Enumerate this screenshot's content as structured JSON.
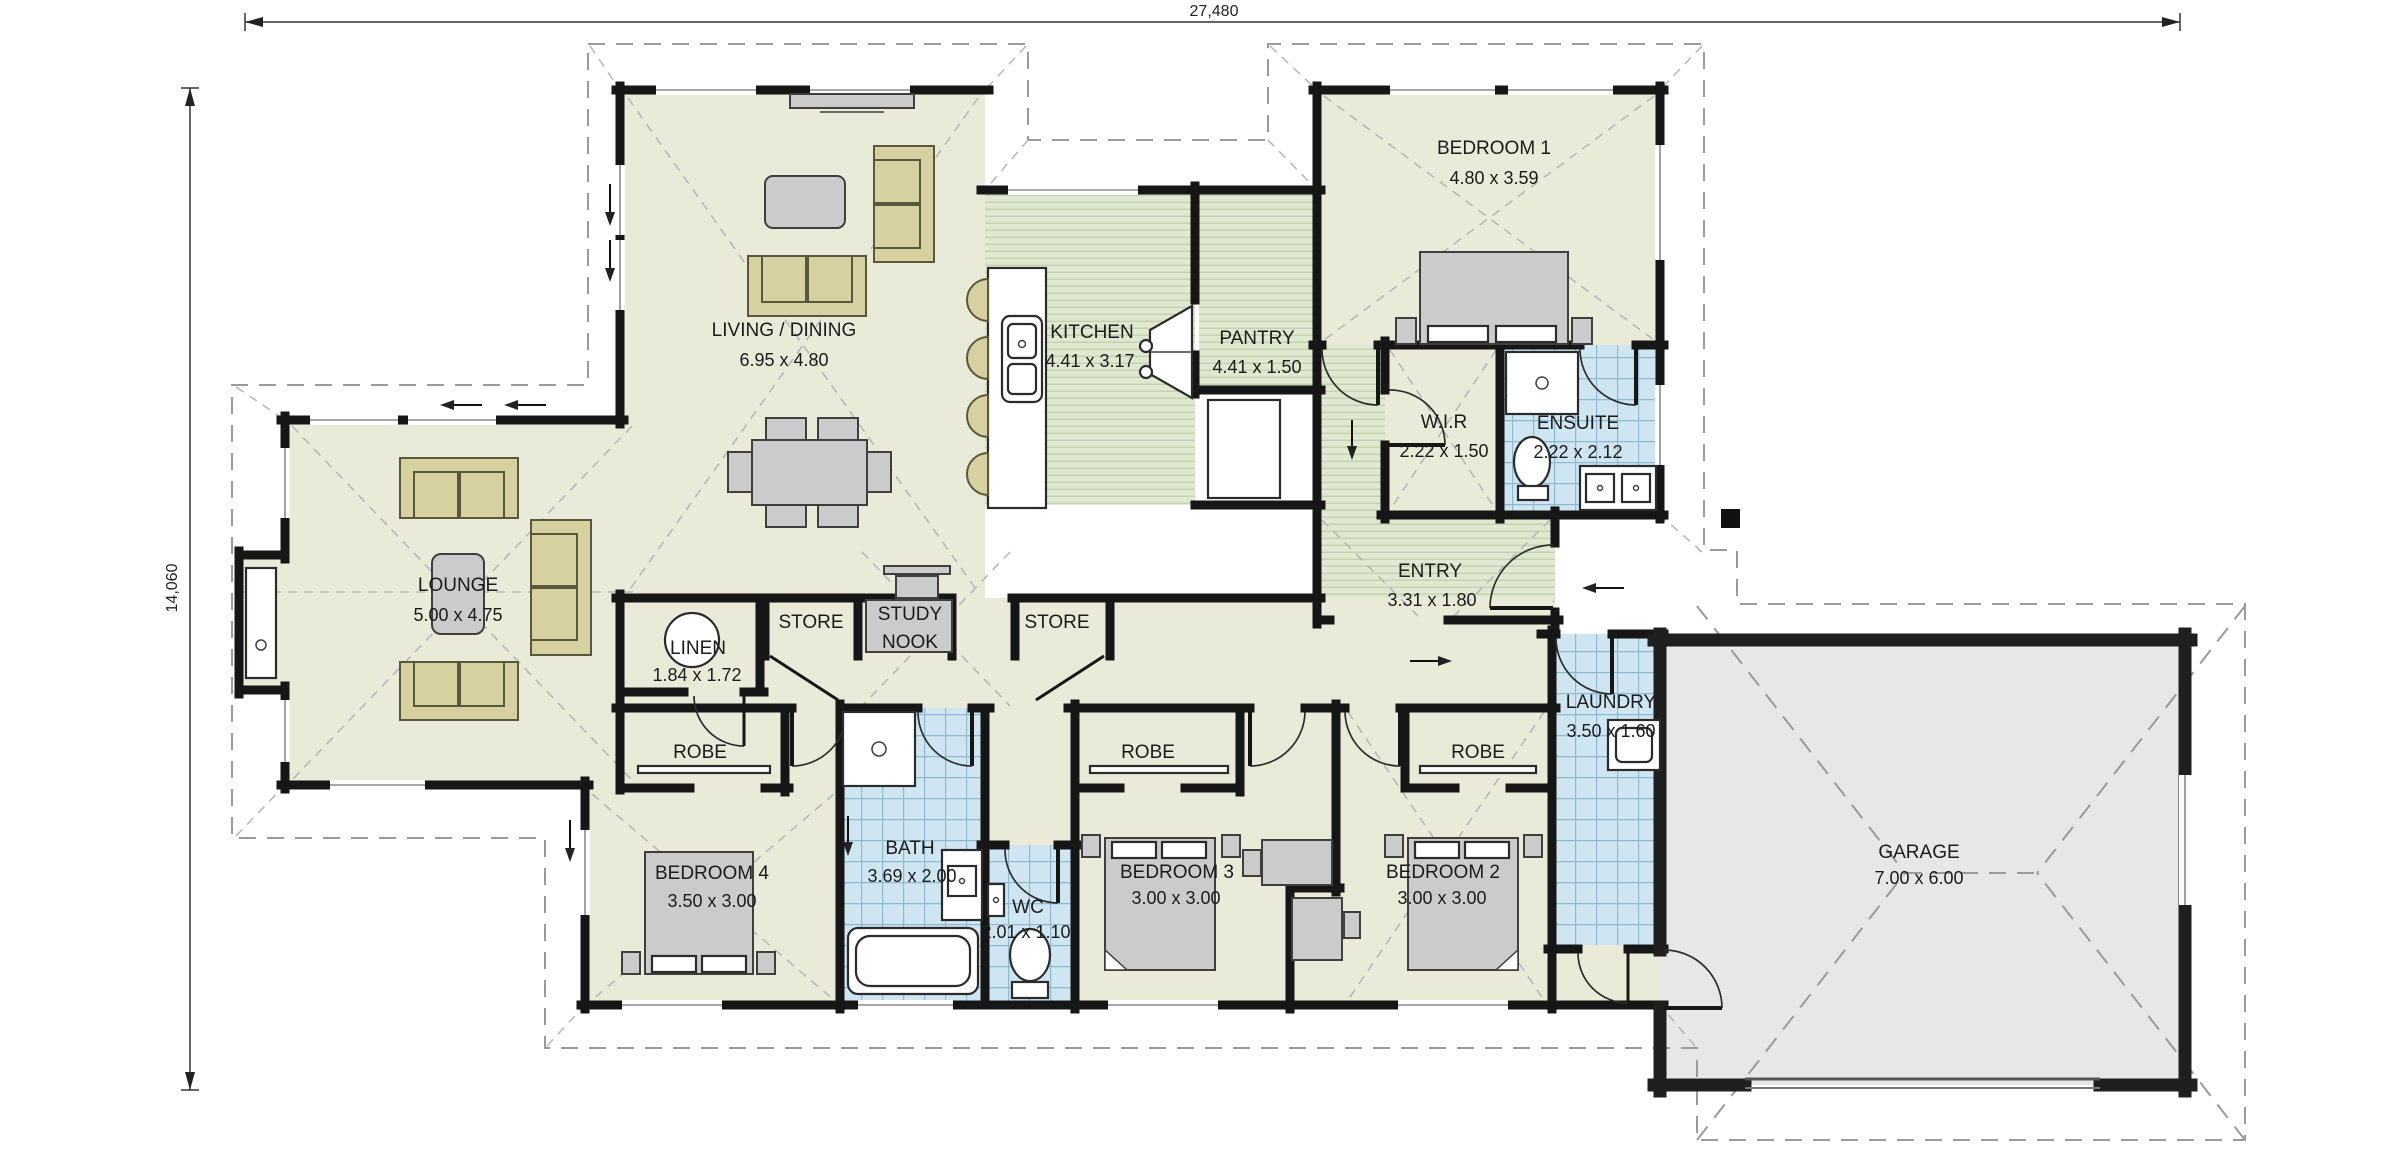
{
  "title": "House floor plan",
  "dimensions": {
    "width_label": "27,480",
    "height_label": "14,060"
  },
  "rooms": {
    "living": {
      "name": "LIVING / DINING",
      "dims": "6.95 x 4.80"
    },
    "kitchen": {
      "name": "KITCHEN",
      "dims": "4.41 x 3.17"
    },
    "pantry": {
      "name": "PANTRY",
      "dims": "4.41 x 1.50"
    },
    "bedroom1": {
      "name": "BEDROOM 1",
      "dims": "4.80 x 3.59"
    },
    "wir": {
      "name": "W.I.R",
      "dims": "2.22 x 1.50"
    },
    "ensuite": {
      "name": "ENSUITE",
      "dims": "2.22 x 2.12"
    },
    "entry": {
      "name": "ENTRY",
      "dims": "3.31 x 1.80"
    },
    "lounge": {
      "name": "LOUNGE",
      "dims": "5.00 x 4.75"
    },
    "linen": {
      "name": "LINEN",
      "dims": "1.84 x 1.72"
    },
    "store1": {
      "name": "STORE"
    },
    "study_nook": {
      "line1": "STUDY",
      "line2": "NOOK"
    },
    "store2": {
      "name": "STORE"
    },
    "laundry": {
      "name": "LAUNDRY",
      "dims": "3.50 x 1.60"
    },
    "robe1": {
      "name": "ROBE"
    },
    "robe2": {
      "name": "ROBE"
    },
    "robe3": {
      "name": "ROBE"
    },
    "bedroom4": {
      "name": "BEDROOM 4",
      "dims": "3.50 x 3.00"
    },
    "bath": {
      "name": "BATH",
      "dims": "3.69 x 2.00"
    },
    "wc": {
      "name": "WC",
      "dims": "2.01 x 1.10"
    },
    "bedroom3": {
      "name": "BEDROOM 3",
      "dims": "3.00 x 3.00"
    },
    "bedroom2": {
      "name": "BEDROOM 2",
      "dims": "3.00 x 3.00"
    },
    "garage": {
      "name": "GARAGE",
      "dims": "7.00 x 6.00"
    }
  },
  "colors": {
    "wall": "#161616",
    "floor": "#eaead9",
    "timber": "#dfe8d0",
    "timber_line": "#c3d2ac",
    "tile": "#cfe6f2",
    "tile_line": "#8fb9cf",
    "garage": "#e7e7e7",
    "tan": "#d7d0a0",
    "dash": "#9a9a9a",
    "text": "#1b1b1b"
  }
}
